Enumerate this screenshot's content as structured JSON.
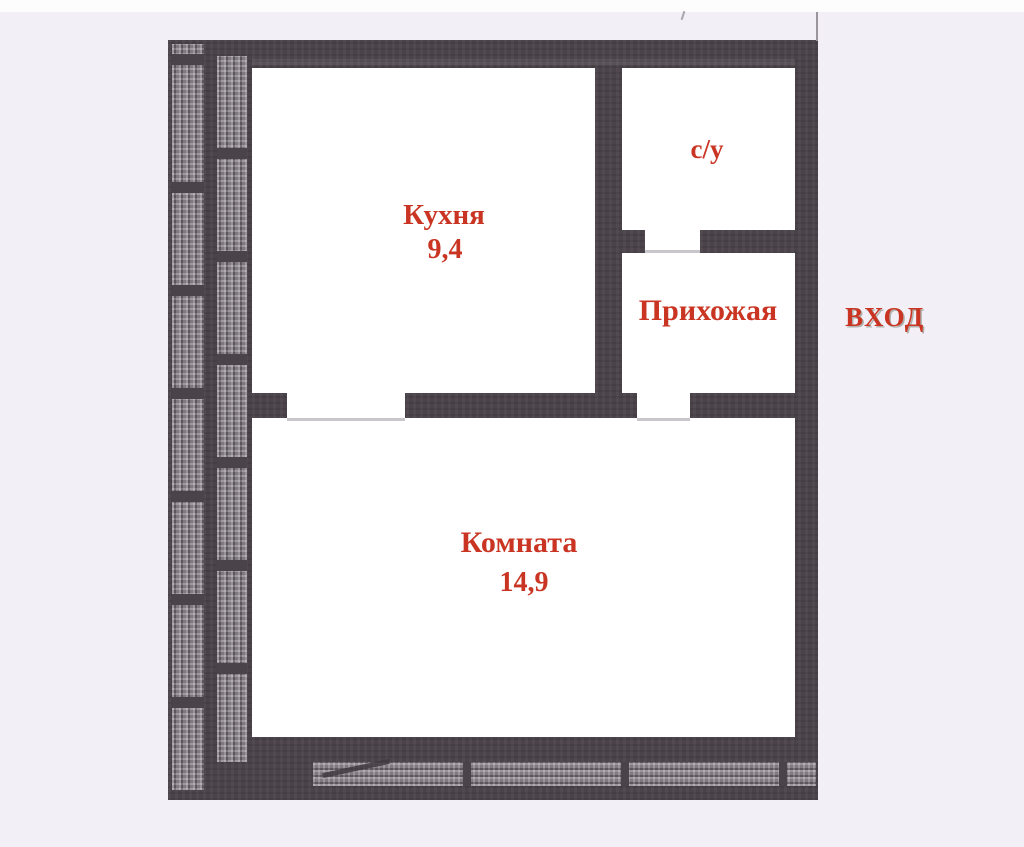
{
  "plan": {
    "rooms": [
      {
        "name": "kitchen",
        "label": "Кухня",
        "area": "9,4"
      },
      {
        "name": "bathroom",
        "label": "с/у",
        "area": ""
      },
      {
        "name": "hallway",
        "label": "Прихожая",
        "area": ""
      },
      {
        "name": "living",
        "label": "Комната",
        "area": "14,9"
      }
    ],
    "entrance": {
      "label": "ВХОД"
    },
    "colors": {
      "wall": "#4b434a",
      "hatch": "#7d757d",
      "room_fill": "#ffffff",
      "page_background": "#f2f0f6",
      "label_red": "#c93522",
      "threshold": "#c8c6ca"
    }
  }
}
